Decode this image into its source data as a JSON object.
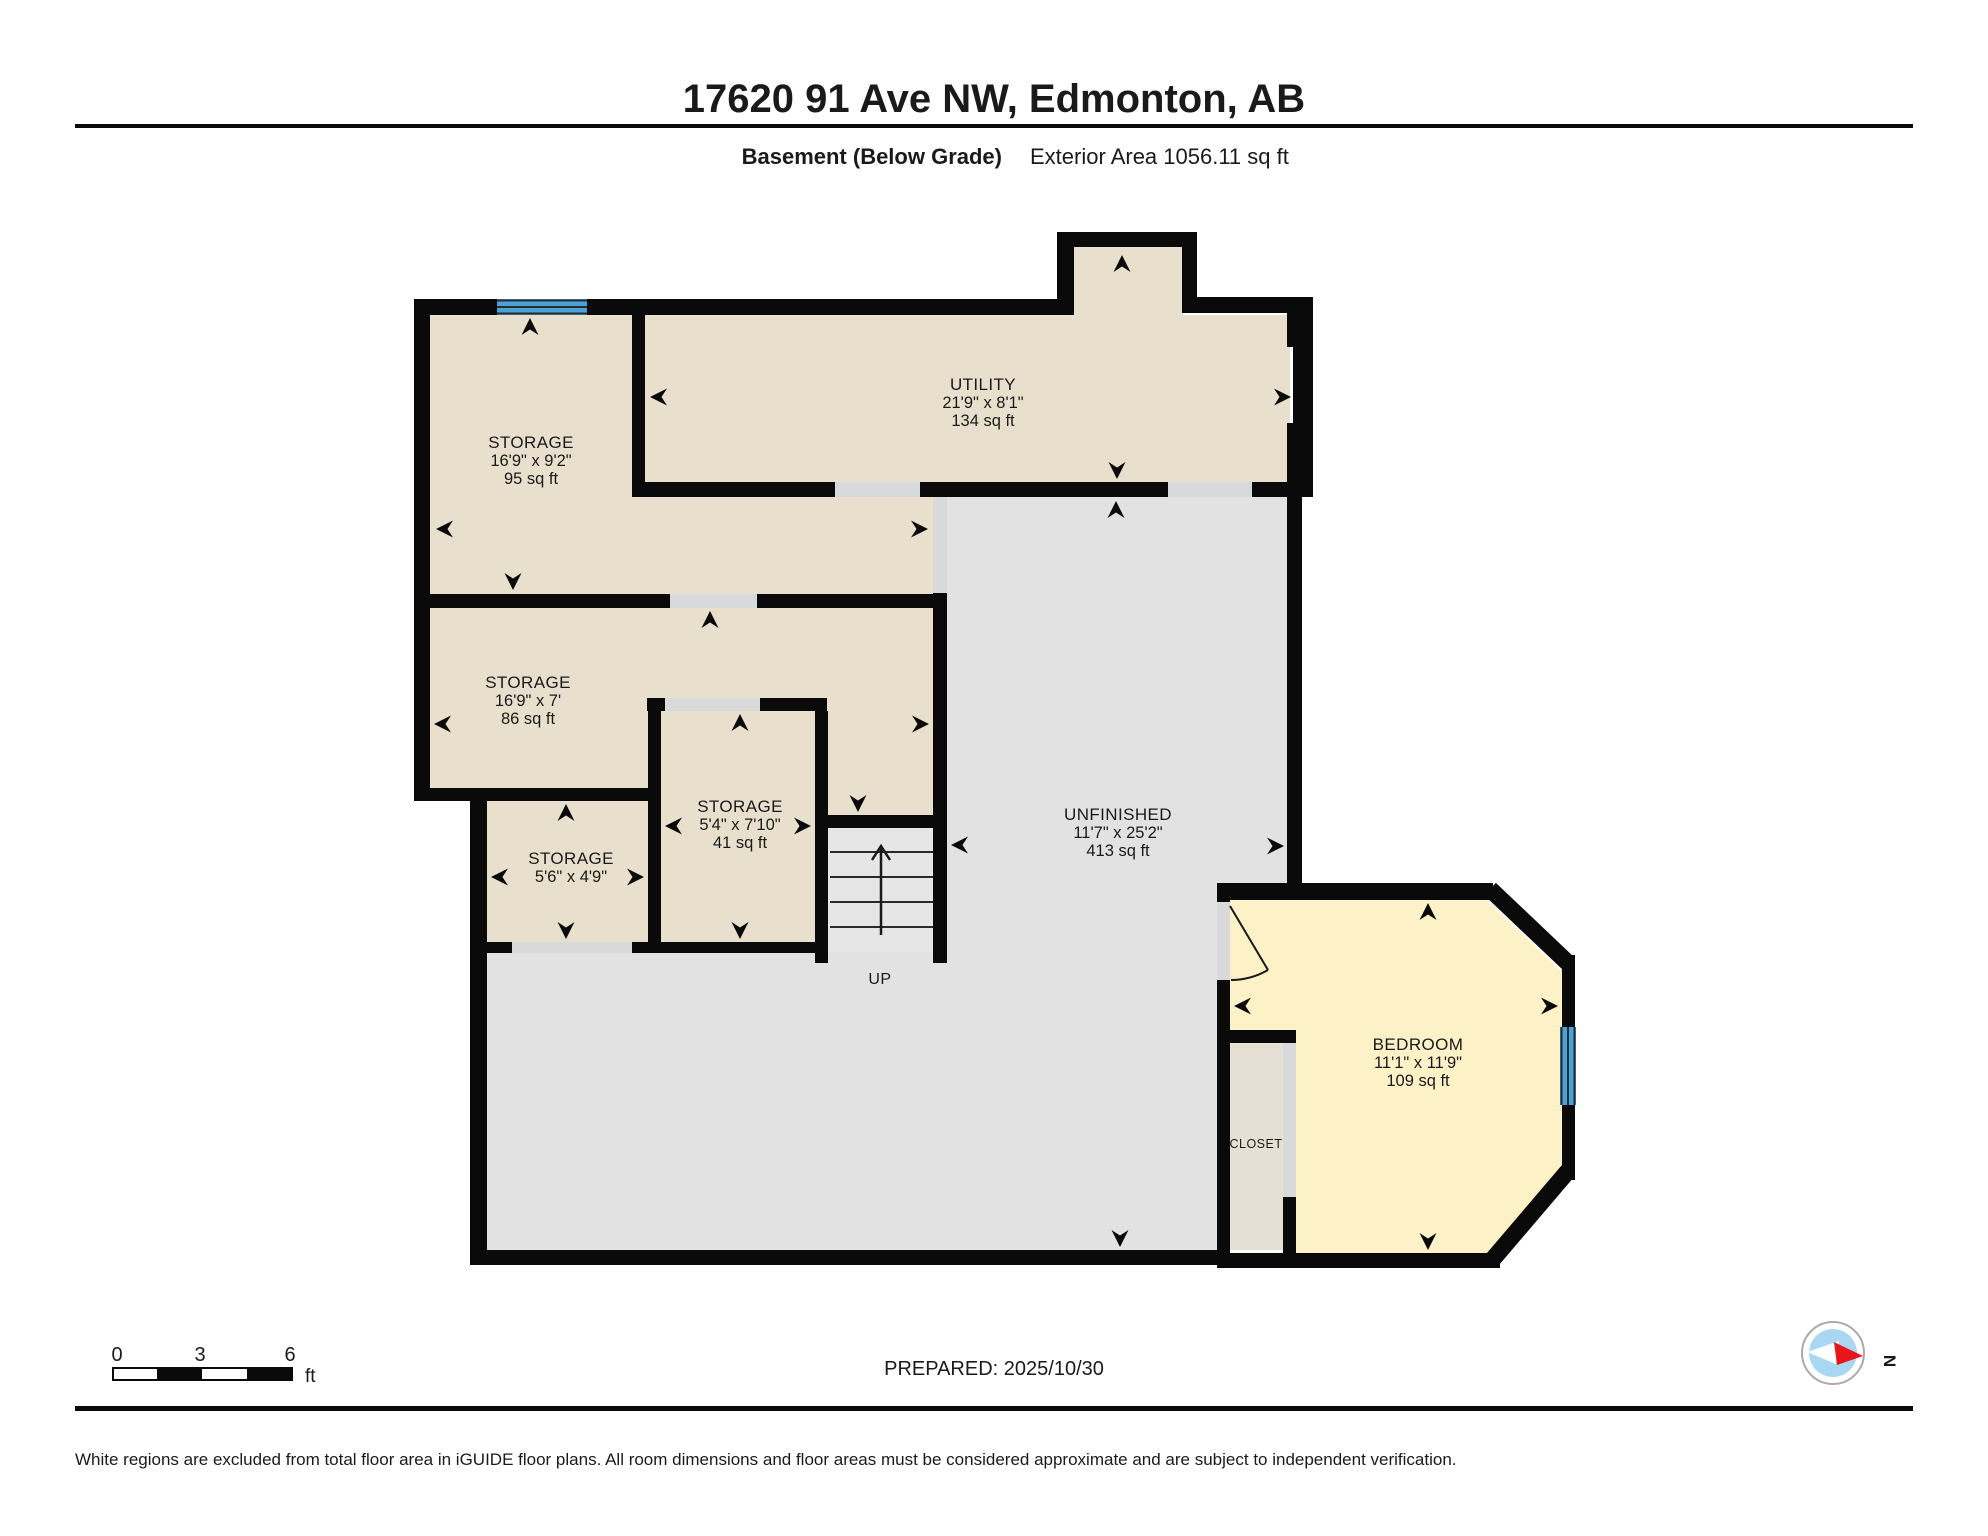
{
  "header": {
    "address": "17620 91 Ave NW, Edmonton, AB",
    "floor": "Basement (Below Grade)",
    "exterior_area": "Exterior Area 1056.11 sq ft"
  },
  "rooms": {
    "storage_a": {
      "name": "STORAGE",
      "dims": "16'9\" x 9'2\"",
      "area": "95 sq ft"
    },
    "utility": {
      "name": "UTILITY",
      "dims": "21'9\" x 8'1\"",
      "area": "134 sq ft"
    },
    "storage_b": {
      "name": "STORAGE",
      "dims": "16'9\" x 7'",
      "area": "86 sq ft"
    },
    "storage_c": {
      "name": "STORAGE",
      "dims": "5'4\" x 7'10\"",
      "area": "41 sq ft"
    },
    "storage_d": {
      "name": "STORAGE",
      "dims": "5'6\" x 4'9\""
    },
    "unfinished": {
      "name": "UNFINISHED",
      "dims": "11'7\" x 25'2\"",
      "area": "413 sq ft"
    },
    "bedroom": {
      "name": "BEDROOM",
      "dims": "11'1\" x 11'9\"",
      "area": "109 sq ft"
    },
    "closet": {
      "name": "CLOSET"
    },
    "stairs": {
      "label": "UP"
    }
  },
  "scale_bar": {
    "tick0": "0",
    "tick3": "3",
    "tick6": "6",
    "unit": "ft"
  },
  "prepared": {
    "label": "PREPARED: 2025/10/30"
  },
  "compass": {
    "north": "N"
  },
  "footer": {
    "disclaimer": "White regions are excluded from total floor area in iGUIDE floor plans. All room dimensions and floor areas must be considered approximate and are subject to independent verification."
  },
  "colors": {
    "wall": "#0a0a0a",
    "floor_beige": "#e8e0cd",
    "floor_gray": "#e2e2e2",
    "floor_stairs": "#e6e6e6",
    "floor_yellow": "#fdf2c7",
    "floor_closet": "#e6dfd3",
    "door_opening": "#d8d9db",
    "window_blue": "#4aa3d8",
    "compass_blue": "#a9d7f2",
    "compass_red": "#e8151b"
  }
}
